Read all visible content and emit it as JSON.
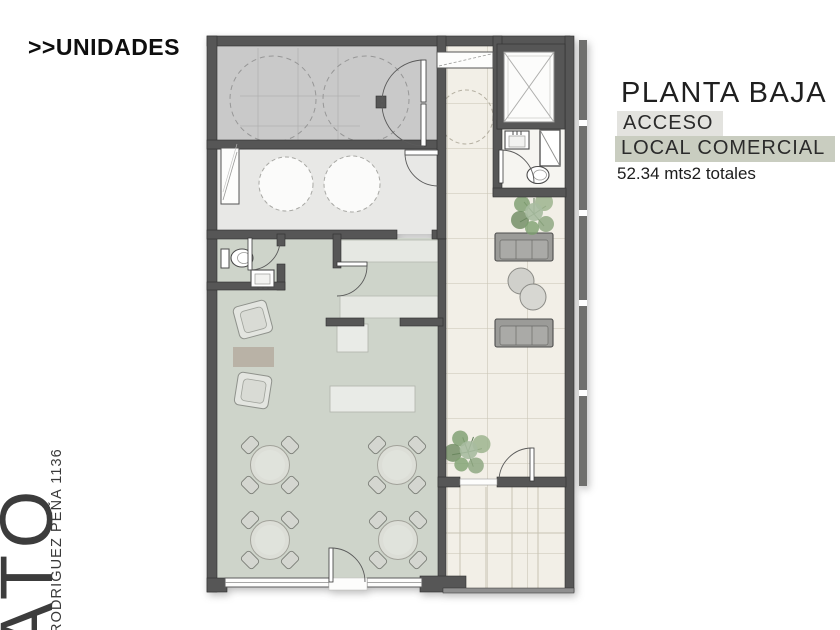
{
  "header": {
    "label": ">>UNIDADES"
  },
  "info_panel": {
    "title": "PLANTA BAJA",
    "access_label": "ACCESO",
    "unit_label": "LOCAL COMERCIAL",
    "area_label": "52.34 mts2 totales",
    "access_highlight_color": "#e3e3df",
    "unit_highlight_color": "#c9cdc0"
  },
  "side_label": {
    "brand": "ATO",
    "address": "RODRIGUEZ PEÑA 1136"
  },
  "floorplan": {
    "type": "architectural-ground-floor-plan",
    "colors": {
      "wall": "#565656",
      "commercial_floor": "#ced4ca",
      "garage_floor": "#c9c9c9",
      "utility_floor": "#e8e8e6",
      "tile_floor": "#f2efe7",
      "tile_line": "#c8c3b3",
      "furniture_gray": "#a0a09d",
      "plant_green": "#82a174"
    },
    "contents": {
      "dining_tables": 4,
      "chairs_per_table": 4,
      "sofas": 2,
      "armchairs": 2,
      "round_side_tables": 2,
      "plants": 2,
      "bathrooms": 2,
      "elevator": 1
    }
  }
}
